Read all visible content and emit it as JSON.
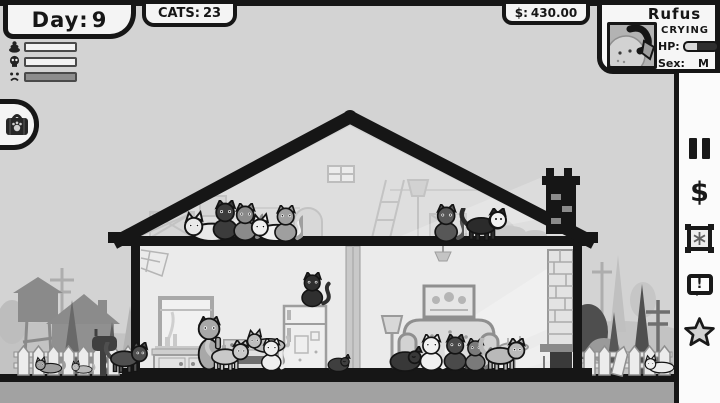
{
  "palette": {
    "ink": "#161616",
    "paper": "#f5f5f5",
    "sky": "#d3d3d3",
    "ground": "#a2a2a2",
    "hp_empty": "#2e2e2e",
    "hp_full": "#d9d9d9",
    "meter_fill": "#8d8d8d"
  },
  "hud": {
    "day": {
      "label": "Day:",
      "value": "9"
    },
    "cats": {
      "label": "CATS:",
      "value": "23"
    },
    "money": {
      "label": "$:",
      "value": "430.00"
    },
    "meters": [
      {
        "icon": "poop-icon",
        "fill_pct": 0
      },
      {
        "icon": "skull-icon",
        "fill_pct": 0
      },
      {
        "icon": "sad-face-icon",
        "fill_pct": 100
      }
    ]
  },
  "cat_panel": {
    "name": "Rufus",
    "status": "Crying",
    "portrait_icon": "cat-face-portrait",
    "hp_label": "HP:",
    "hp_pct": 38,
    "sex_label": "Sex:",
    "sex_value": "M"
  },
  "left_tab": {
    "icon": "pet-carrier-icon"
  },
  "toolbar": {
    "items": [
      {
        "name": "pause-icon",
        "glyph": ""
      },
      {
        "name": "money-icon",
        "glyph": "$"
      },
      {
        "name": "frame-snowflake-icon",
        "glyph": ""
      },
      {
        "name": "alert-bubble-icon",
        "glyph": "!"
      },
      {
        "name": "star-icon",
        "glyph": ""
      }
    ]
  }
}
